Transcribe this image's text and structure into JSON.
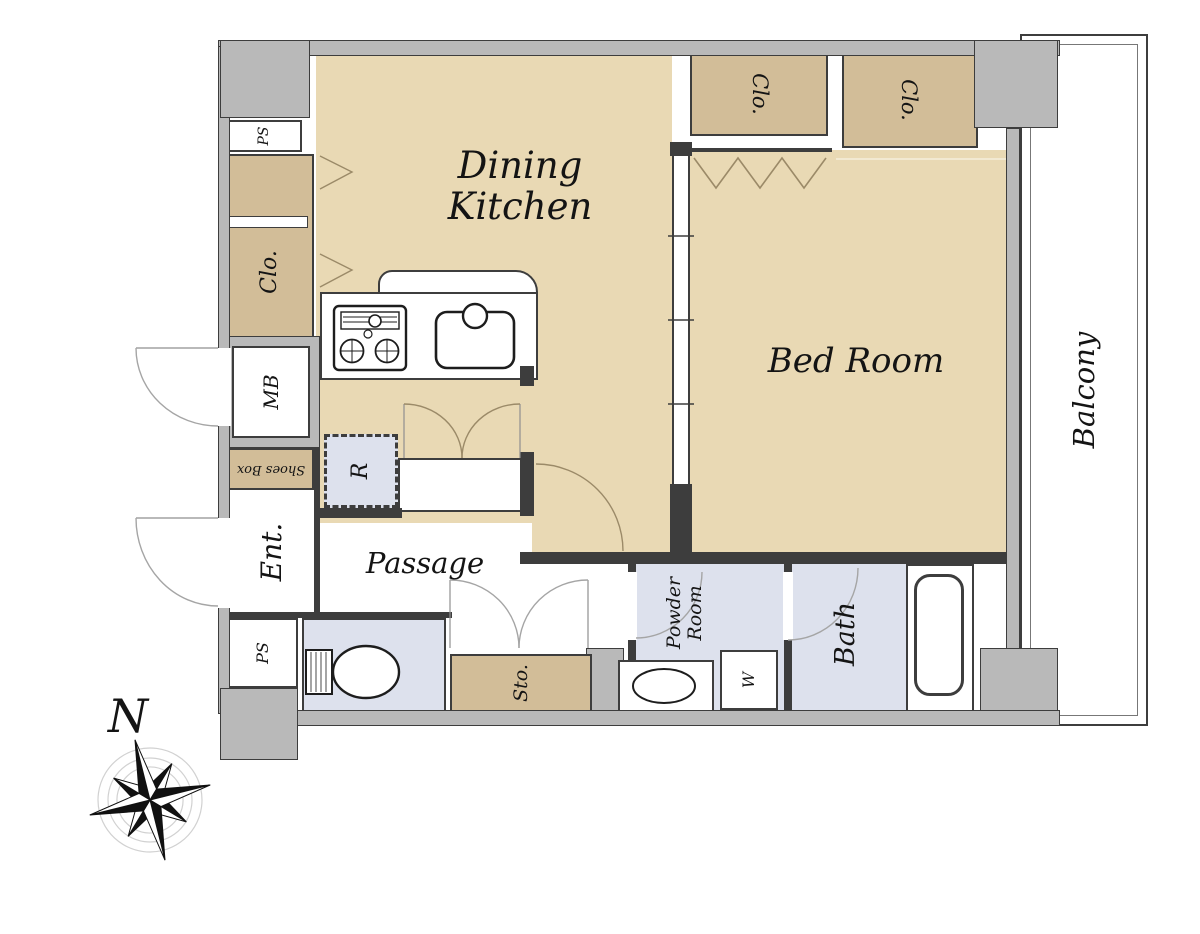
{
  "plan": {
    "rooms": {
      "dining_kitchen": {
        "label": "Dining Kitchen",
        "lines": [
          "Dining",
          "Kitchen"
        ]
      },
      "bed_room": {
        "label": "Bed Room"
      },
      "balcony": {
        "label": "Balcony"
      },
      "passage": {
        "label": "Passage"
      },
      "entrance": {
        "label": "Ent."
      },
      "bath": {
        "label": "Bath"
      },
      "powder_room": {
        "label": "Powder Room",
        "lines": [
          "Powder",
          "Room"
        ]
      },
      "storage": {
        "label": "Sto."
      },
      "closet_left": {
        "label": "Clo."
      },
      "closet_top_left": {
        "label": "Clo."
      },
      "closet_top_right": {
        "label": "Clo."
      },
      "pipe_space_top": {
        "label": "PS"
      },
      "pipe_space_bottom": {
        "label": "PS"
      },
      "meter_box": {
        "label": "MB"
      },
      "shoes_box": {
        "label": "Shoes Box"
      }
    },
    "fixtures": {
      "refrigerator": {
        "label": "R"
      },
      "washing_machine": {
        "label": "W"
      }
    },
    "compass": {
      "north": "N"
    },
    "colors": {
      "floor_tan": "#e9d9b4",
      "closet_tan": "#d2bd98",
      "wet_area_blue": "#dde1ed",
      "wall_gray": "#b9b9b9",
      "line_dark": "#3d3d3d",
      "door_arc_tan": "#9b8a68"
    }
  }
}
